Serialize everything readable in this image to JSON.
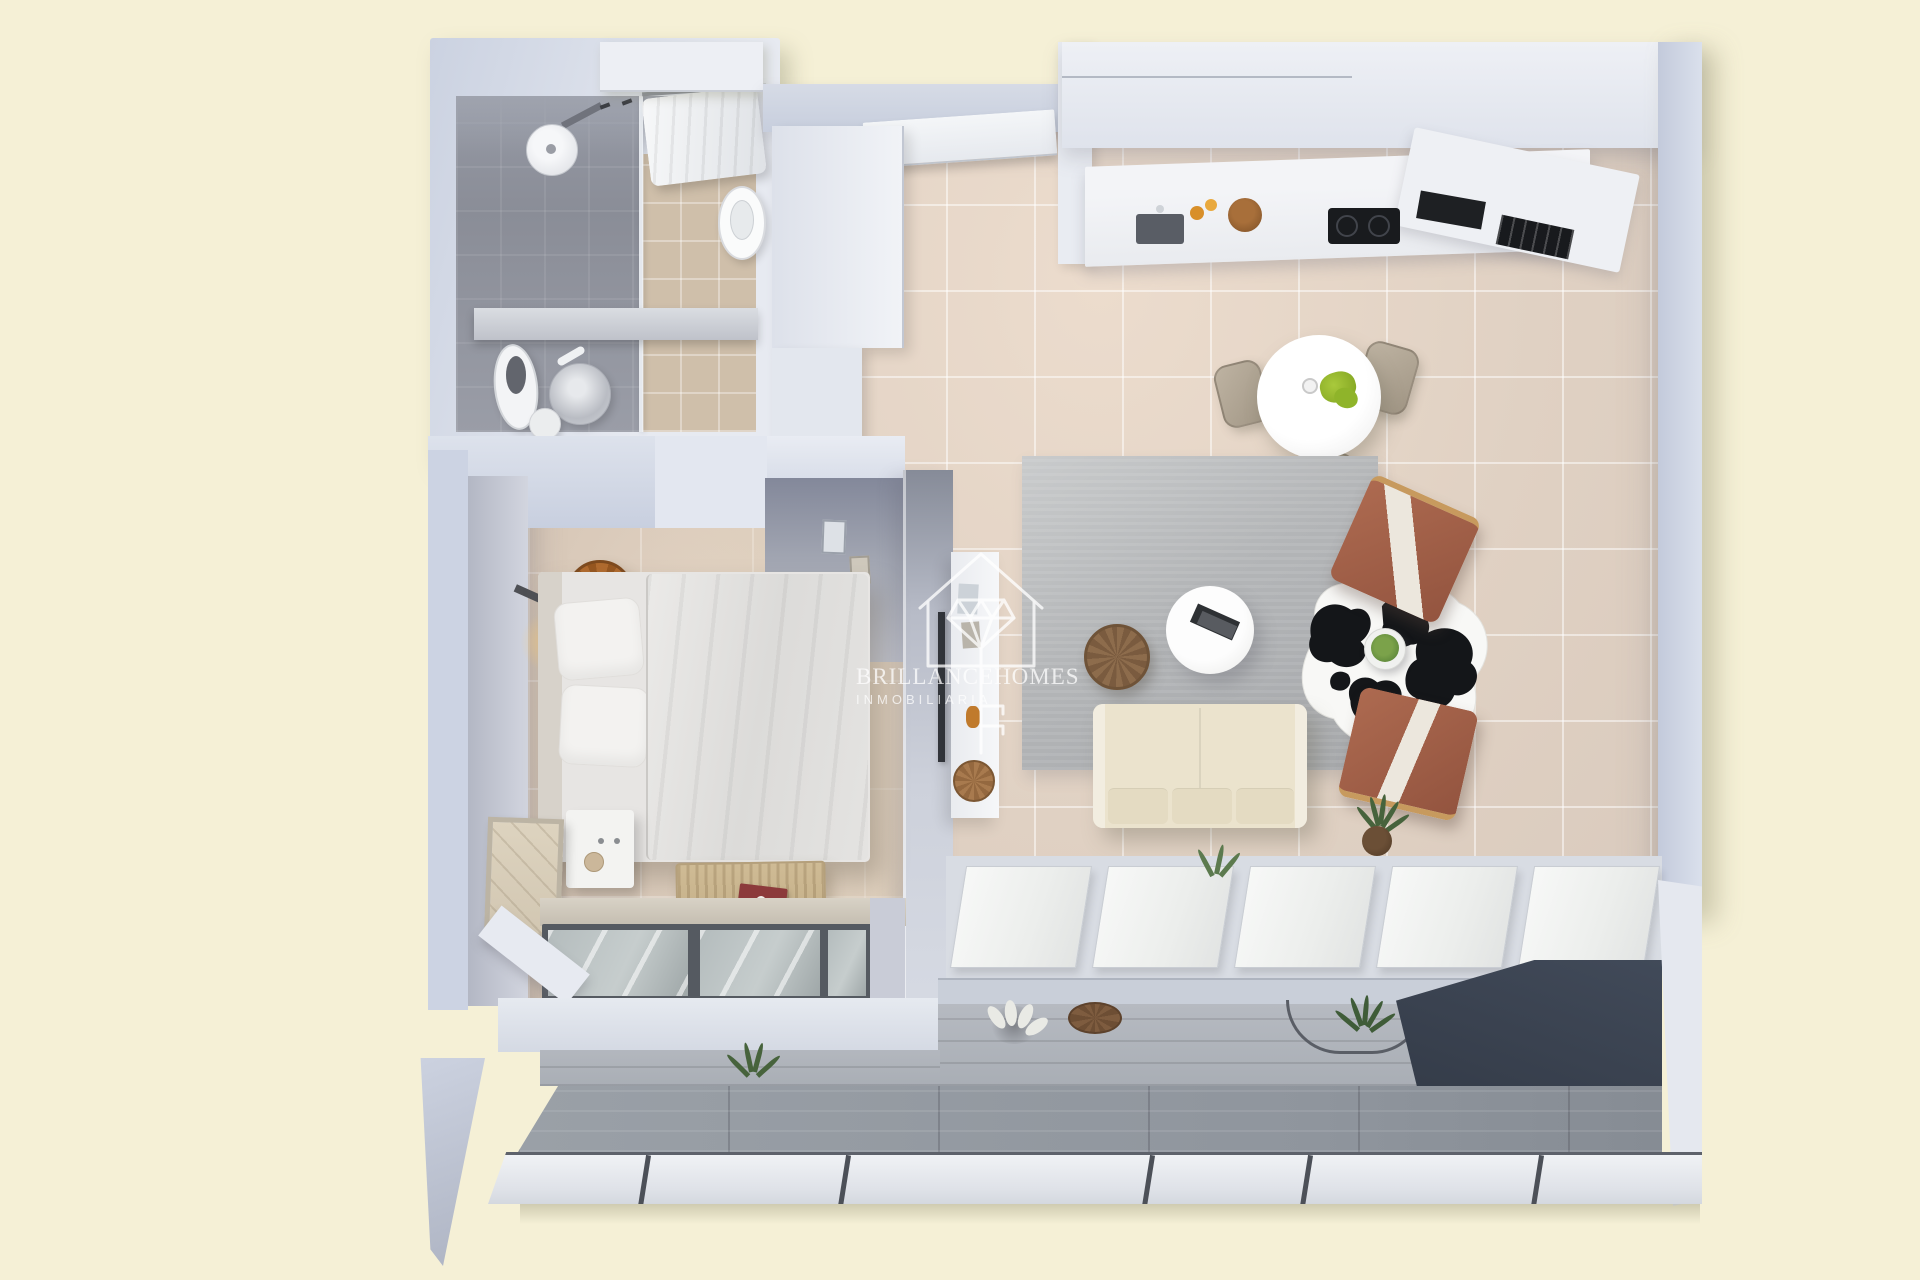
{
  "image": {
    "kind": "3d-rendered-floor-plan-top-view",
    "width": 1920,
    "height": 1280
  },
  "watermark": {
    "brand_word1": "BRILLANCE",
    "brand_word2": "HOMES",
    "subtitle": "INMOBILIARIA",
    "logo_icon": "house-diamond-key-icon",
    "color": "#ffffff"
  },
  "palette": {
    "background_cream": "#f5f0d6",
    "wall_light": "#ccd3e3",
    "wall_white": "#eef0f4",
    "wall_shadow_face": "#868b98",
    "floor_tile_beige": "#e2d3c6",
    "floor_bedroom": "#dbccbd",
    "shower_floor_gray": "#8f929c",
    "bath_tile": "#cfbfaa",
    "rug_gray": "#b3b5b7",
    "sofa_cream": "#ebe3cd",
    "armchair_terracotta": "#a2604a",
    "wood_tan": "#c79a5e",
    "pouf_brown": "#8d6c4c",
    "cowhide_black": "#141619",
    "cowhide_white": "#f8f8f6",
    "plant_green": "#6f9c44",
    "lime_green": "#a9c93c",
    "counter_white": "#f0f2f5",
    "cooktop_black": "#191b1e",
    "terrace_floor": "#9aa0a7",
    "terrace_wall": "#b0b4bb",
    "navy_wall": "#3c4452",
    "bench_rattan": "#c9b48d",
    "book_red": "#8c3a3b",
    "lamp_glow": "#ffcd73"
  },
  "rooms": {
    "bathroom": {
      "items": [
        "walk-in-shower",
        "shower-head",
        "glass-screen",
        "towel-rail",
        "towels",
        "toilet",
        "vanity-counter",
        "round-basin",
        "bidet",
        "stool"
      ]
    },
    "entry_hall": {
      "items": [
        "entry-door",
        "wardrobe"
      ]
    },
    "kitchen": {
      "items": [
        "upper-cabinets",
        "counter",
        "sink",
        "bottles",
        "bowl",
        "induction-cooktop",
        "oven",
        "appliance"
      ]
    },
    "dining": {
      "items": [
        "round-white-table",
        "dining-chair-left",
        "dining-chair-right",
        "dining-chair-bottom",
        "green-centerpiece",
        "cup"
      ]
    },
    "living": {
      "items": [
        "gray-area-rug",
        "cream-sofa",
        "round-coffee-table",
        "books",
        "woven-pouf",
        "cowhide-rug",
        "terracotta-armchair-top",
        "terracotta-armchair-bottom",
        "plant-tray",
        "potted-plant",
        "media-shelf",
        "tv",
        "decor-basket"
      ]
    },
    "bedroom": {
      "items": [
        "double-bed",
        "headboard",
        "pillows",
        "duvet",
        "nightstand",
        "rattan-pendant-lamp",
        "wall-lamp",
        "storage-bench",
        "red-book",
        "picture-frame",
        "window",
        "window-sill"
      ]
    },
    "terrace": {
      "items": [
        "sliding-glass-doors",
        "planked-wall",
        "terrace-floor",
        "white-plant",
        "hanging-basket",
        "hanging-chair-arc",
        "spiky-plant",
        "dark-accent-wall",
        "glass-railing",
        "railing-posts"
      ]
    }
  }
}
